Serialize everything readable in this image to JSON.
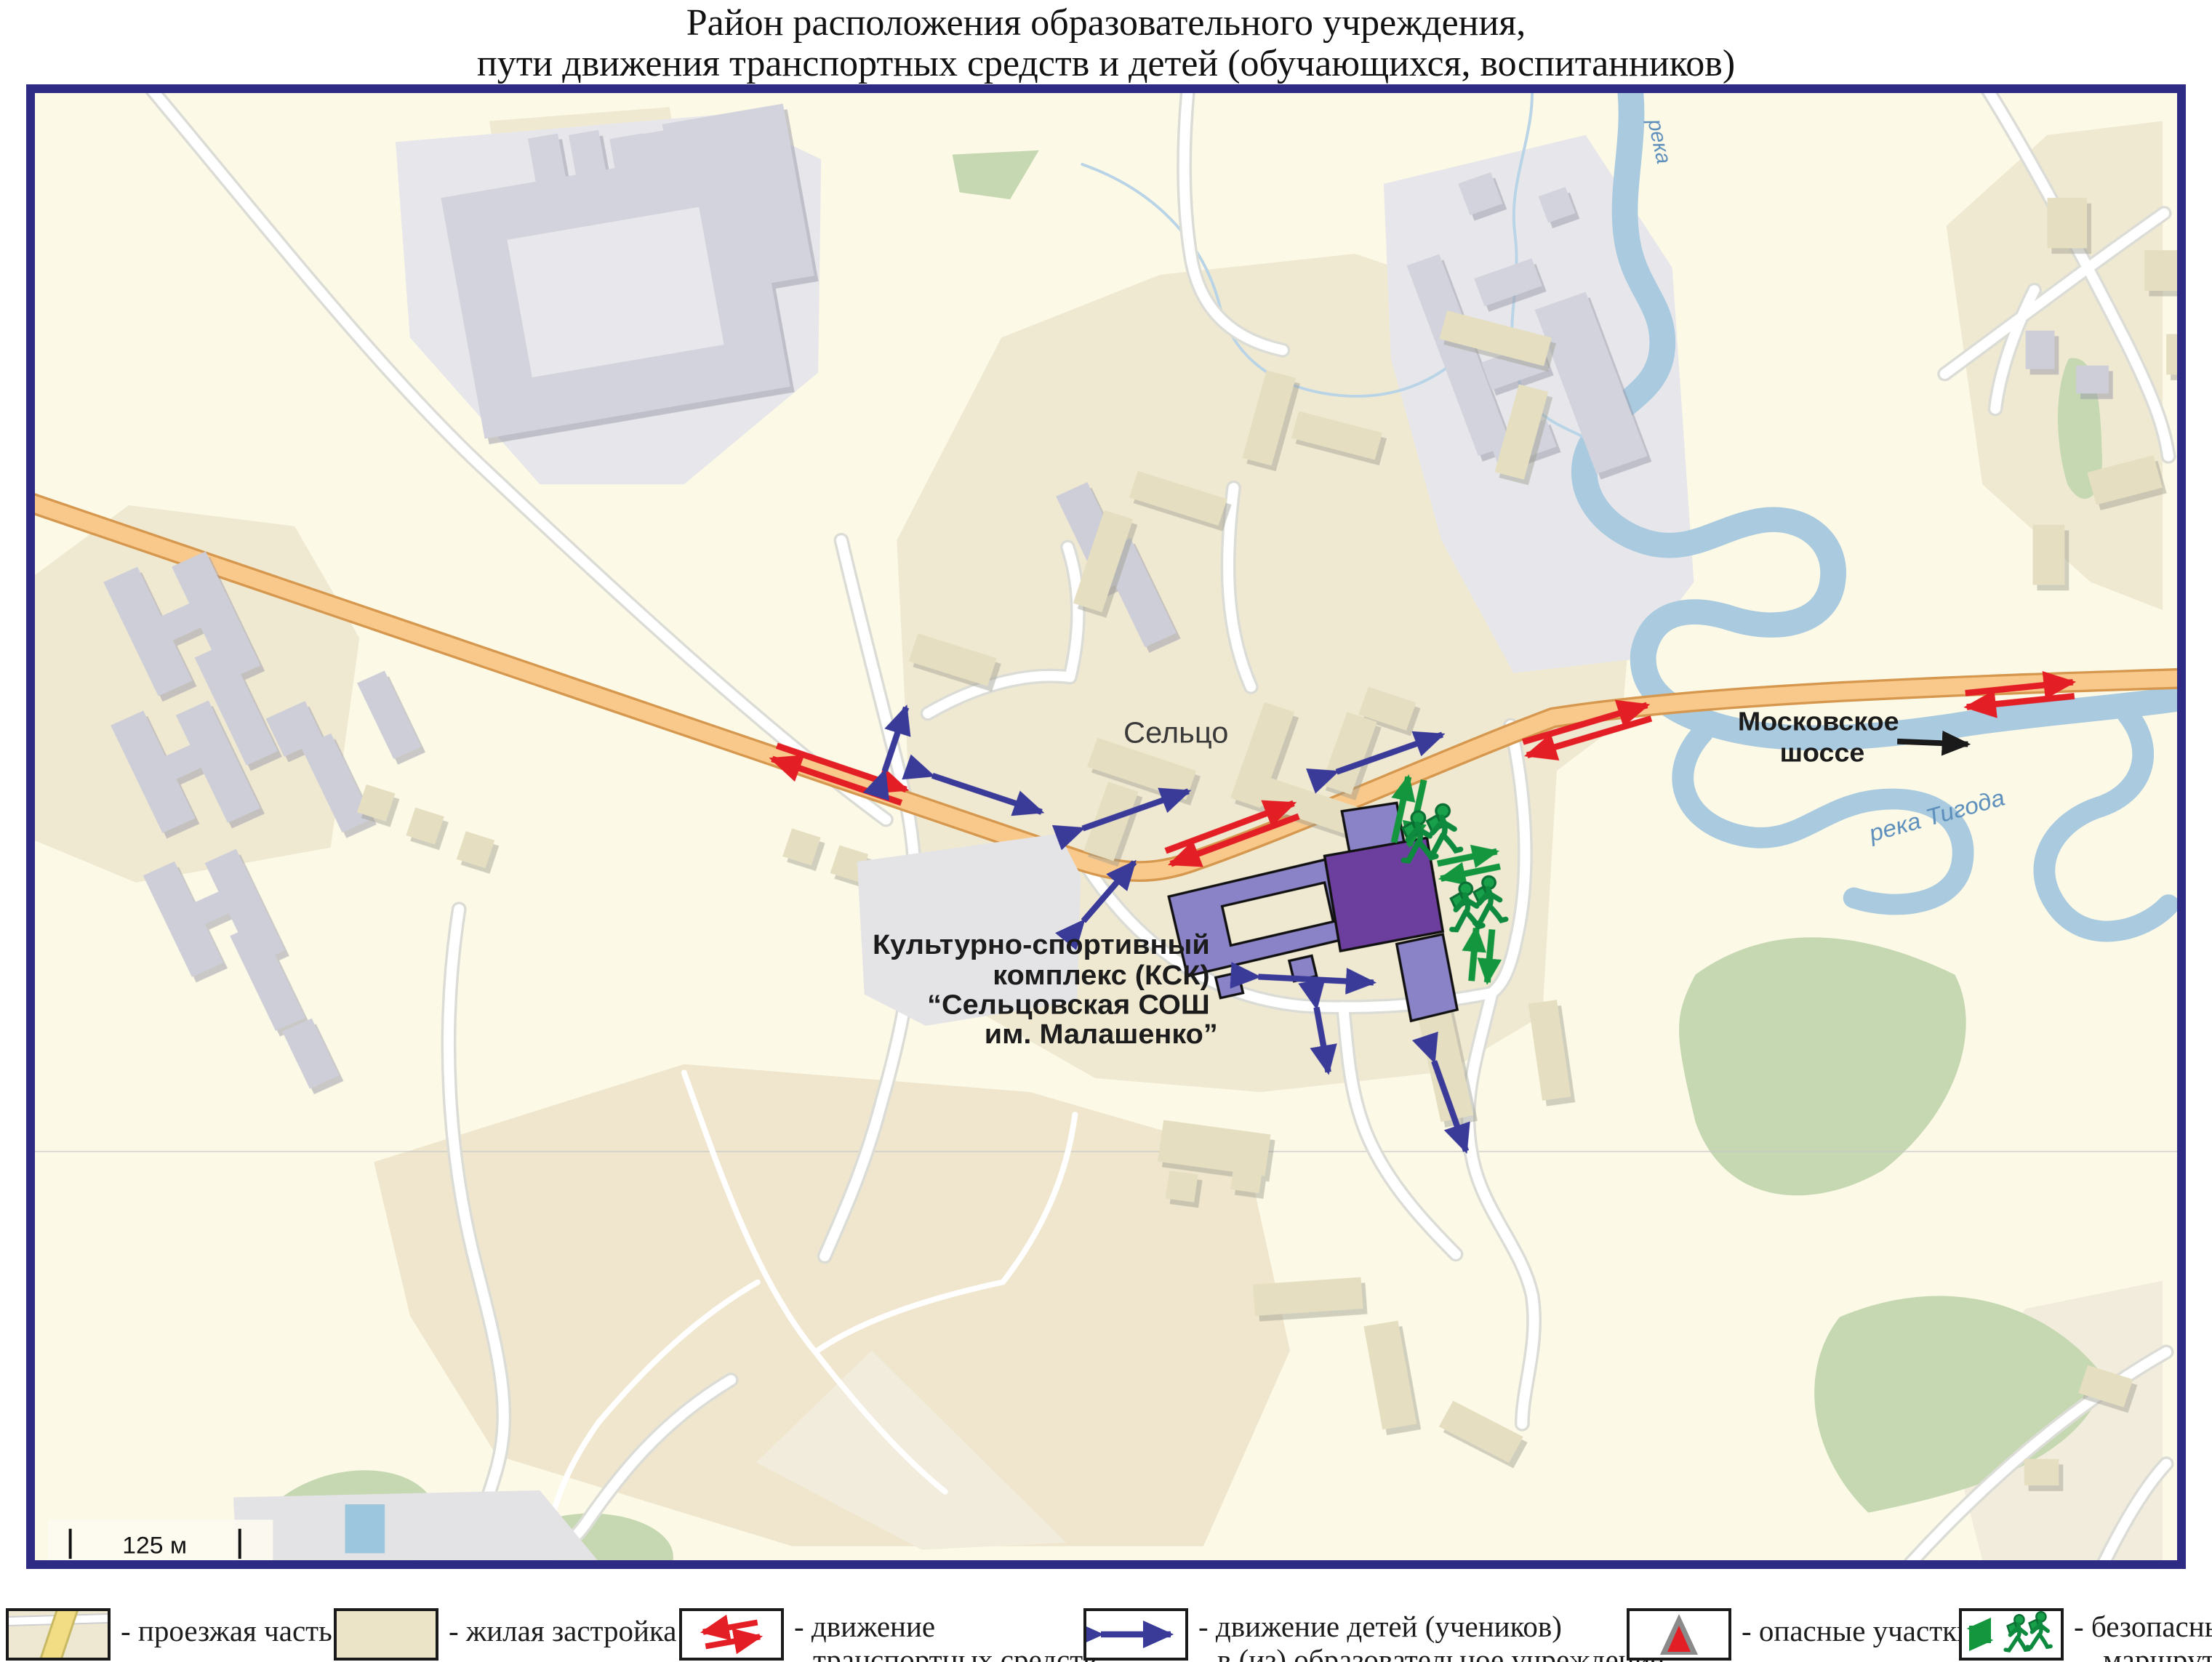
{
  "title": {
    "line1": "Район расположения образовательного учреждения,",
    "line2": "пути движения транспортных средств и детей (обучающихся, воспитанников)"
  },
  "map": {
    "labels": {
      "settlement": "Сельцо",
      "highway_l1": "Московское",
      "highway_l2": "шоссе",
      "river_main": "река Тигода",
      "river_top": "река",
      "school_l1": "Культурно-спортивный",
      "school_l2": "комплекс (КСК)",
      "school_l3": "“Сельцовская СОШ",
      "school_l4": "им. Малашенко”"
    },
    "scale_label": "125 м"
  },
  "legend": {
    "items": [
      {
        "icon": "road-sample-icon",
        "l1": "- проезжая часть",
        "l2": ""
      },
      {
        "icon": "residential-sample-icon",
        "l1": "- жилая застройка",
        "l2": ""
      },
      {
        "icon": "vehicle-arrows-icon",
        "l1": "- движение",
        "l2": "транспортных средств"
      },
      {
        "icon": "children-arrow-icon",
        "l1": "- движение детей (учеников)",
        "l2": "в (из) образовательное учреждение"
      },
      {
        "icon": "danger-triangle-icon",
        "l1": "- опасные участки",
        "l2": ""
      },
      {
        "icon": "safe-route-icon",
        "l1": "- безопасный",
        "l2": "маршрут"
      }
    ]
  },
  "colors": {
    "map_border": "#2e2b85",
    "background": "#fcf9e6",
    "residential_zone": "#f0e9d2",
    "building_beige": "#e5dec1",
    "building_gray": "#cdced8",
    "industrial_gray": "#e7e7eb",
    "green_area": "#c5d8b2",
    "river": "#a9cadf",
    "highway": "#f9c98b",
    "highway_edge": "#d6984f",
    "road_white": "#ffffff",
    "school_light": "#8a83c8",
    "school_dark": "#6c3e9e",
    "vehicle_arrow": "#e31e24",
    "children_arrow": "#3a3a99",
    "safe_route": "#14963f",
    "danger_gray": "#8a8a8a",
    "danger_red": "#e31e24",
    "label_text": "#1c1c1c",
    "river_text": "#5d8fbc"
  }
}
